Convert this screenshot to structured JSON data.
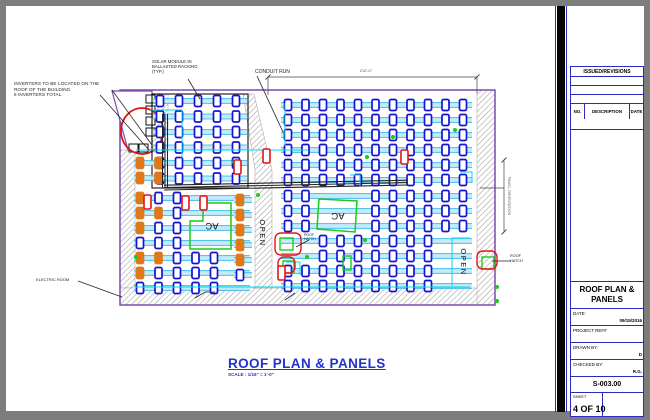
{
  "notes": {
    "inverters": "INVERTERS TO BE LOCATED ON THE\nROOF OF THE BUILDING.\n6 INVERTERS TOTAL.",
    "solar_module": "SOLAR MODULE IN\nBALLASTED RACKING\n(TYP.)",
    "conduit_run": "CONDUIT RUN",
    "electric_room": "ELECTRIC ROOM",
    "roof_hatch_right": "ROOF\nHATCH",
    "roof_hatch_center": "ROOF\nHATCH",
    "ac1": "AC",
    "ac2": "AC",
    "open1": "OPEN",
    "open2": "OPEN",
    "top_dimension": "210'-0\"",
    "right_dimension": "PANEL ORIENTATION"
  },
  "drawing_title": {
    "title": "ROOF PLAN & PANELS",
    "scale": "SCALE : 1/16\" = 1'-0\""
  },
  "title_block": {
    "issued_revisions": "ISSUED/REVISIONS",
    "col_no": "NO.",
    "col_description": "DESCRIPTION",
    "col_date": "DATE",
    "title_line1": "ROOF PLAN &",
    "title_line2": "PANELS",
    "date_label": "DATE:",
    "date_value": "09/15/2016",
    "project_ref_label": "PROJECT REF#",
    "project_ref_value": "",
    "drawn_by_label": "DRAWN BY:",
    "drawn_by_value": "D",
    "checked_by_label": "CHECKED BY:",
    "checked_by_value": "R.G.",
    "sheet_number": "S-003.00",
    "sheet_label": "SHEET",
    "sheet_value": "4 OF 10"
  },
  "plan": {
    "colors": {
      "hatch": "#9f9f9f",
      "outline": "#7c4bad",
      "rail": "#5bc4ee",
      "railmid": "#c4ebfa",
      "module": "#1515d0",
      "orange": "#e07818",
      "red": "#e51313",
      "green": "#19cc19",
      "cyan": "#00d8e8",
      "black": "#1a1a1a",
      "dim": "#444444"
    },
    "roof": {
      "x": 120,
      "y": 90,
      "w": 375,
      "h": 215
    },
    "hatch_rects": [
      [
        120,
        150,
        15,
        138
      ],
      [
        120,
        288,
        375,
        17
      ],
      [
        477,
        90,
        18,
        215
      ],
      [
        152,
        94,
        16,
        58
      ]
    ],
    "hatch_polys": [
      "243,94 254,94 272,170 272,288 255,288 255,170"
    ],
    "trapezoid": "112,91 152,91 152,150 128,150",
    "inverter_boxes": [
      [
        146,
        95
      ],
      [
        146,
        106
      ],
      [
        146,
        117
      ],
      [
        146,
        128
      ],
      [
        129,
        144
      ],
      [
        139,
        144
      ]
    ],
    "red_ellipse": {
      "cx": 142,
      "cy": 131,
      "rx": 21,
      "ry": 23
    },
    "array_frame": [
      152,
      94,
      96,
      94
    ],
    "arrays": [
      {
        "x0": 160,
        "y0": 101,
        "cols": 5,
        "dx": 19,
        "rows": 6,
        "dy": 15.5,
        "railX1": 153,
        "railX2": 247,
        "skip": [],
        "orange": []
      },
      {
        "x0": 288,
        "y0": 105,
        "cols": 11,
        "dx": 17.5,
        "rows": 6,
        "dy": 15,
        "railX1": 281,
        "railX2": 472,
        "skip": [],
        "orange": []
      },
      {
        "x0": 288,
        "y0": 196,
        "cols": 11,
        "dx": 17.5,
        "rows": 7,
        "dy": 15,
        "railX1": 281,
        "railX2": 472,
        "skip": [
          [
            2,
            0
          ],
          [
            3,
            0
          ],
          [
            4,
            0
          ],
          [
            2,
            1
          ],
          [
            3,
            1
          ],
          [
            4,
            1
          ],
          [
            2,
            2
          ],
          [
            3,
            2
          ],
          [
            4,
            2
          ],
          [
            0,
            3
          ],
          [
            1,
            3
          ],
          [
            0,
            4
          ],
          [
            1,
            4
          ],
          [
            9,
            3
          ],
          [
            10,
            3
          ],
          [
            9,
            4
          ],
          [
            10,
            4
          ],
          [
            9,
            5
          ],
          [
            10,
            5
          ],
          [
            9,
            6
          ],
          [
            10,
            6
          ]
        ],
        "orange": []
      },
      {
        "x0": 140,
        "y0": 198,
        "cols": 5,
        "dx": 18.5,
        "rows": 7,
        "dy": 15,
        "railX1": 134,
        "railX2": 250,
        "skip": [
          [
            3,
            0
          ],
          [
            4,
            0
          ],
          [
            3,
            1
          ],
          [
            4,
            1
          ],
          [
            3,
            2
          ],
          [
            4,
            2
          ],
          [
            3,
            3
          ],
          [
            4,
            3
          ]
        ],
        "orange": [
          [
            0,
            0
          ],
          [
            0,
            1
          ],
          [
            0,
            2
          ],
          [
            1,
            1
          ],
          [
            0,
            4
          ],
          [
            1,
            4
          ],
          [
            0,
            5
          ]
        ]
      },
      {
        "x0": 240,
        "y0": 200,
        "cols": 1,
        "dx": 18,
        "rows": 6,
        "dy": 15,
        "railX1": 234,
        "railX2": 252,
        "skip": [],
        "orange": [
          [
            0,
            0
          ],
          [
            0,
            1
          ],
          [
            0,
            2
          ],
          [
            0,
            3
          ],
          [
            0,
            4
          ]
        ]
      },
      {
        "x0": 140,
        "y0": 163,
        "cols": 2,
        "dx": 18.5,
        "rows": 2,
        "dy": 15,
        "railX1": 134,
        "railX2": 168,
        "skip": [],
        "orange": [
          [
            0,
            0
          ],
          [
            1,
            0
          ],
          [
            0,
            1
          ],
          [
            1,
            1
          ]
        ]
      }
    ],
    "module": {
      "w": 7,
      "h": 11,
      "rx": 1.5
    },
    "conduit": {
      "x1": 164,
      "x2": 408,
      "y1": 190,
      "y2": 185,
      "lines": 3,
      "gap": 2.4,
      "verticals": [
        162.5,
        165,
        167.5
      ],
      "vy1": 114,
      "vy2": 188
    },
    "ac_shapes": [
      "190,221 203,221 203,203 231,203 231,249 190,249",
      "319,199 357,201 355,232 317,229"
    ],
    "green_squares": [
      [
        280,
        238,
        13,
        12
      ],
      [
        283,
        261,
        11,
        12
      ],
      [
        482,
        257,
        12,
        12
      ],
      [
        343,
        256,
        8,
        14
      ]
    ],
    "green_dots": [
      [
        234,
        162
      ],
      [
        367,
        157
      ],
      [
        393,
        137
      ],
      [
        365,
        240
      ],
      [
        307,
        257
      ],
      [
        497,
        287
      ],
      [
        497,
        301
      ],
      [
        136,
        257
      ],
      [
        258,
        195
      ],
      [
        455,
        130
      ]
    ],
    "red_rounds": [
      [
        275,
        233,
        26,
        22
      ],
      [
        278,
        257,
        17,
        16
      ],
      [
        477,
        251,
        20,
        18
      ]
    ],
    "red_modules": [
      [
        234,
        160
      ],
      [
        263,
        149
      ],
      [
        182,
        196
      ],
      [
        200,
        196
      ],
      [
        401,
        150
      ],
      [
        278,
        266
      ],
      [
        144,
        195
      ]
    ],
    "cyan_lines": [
      [
        150,
        110,
        182,
        110,
        182,
        158
      ],
      [
        136,
        150,
        308,
        150
      ],
      [
        285,
        103,
        285,
        146
      ],
      [
        460,
        172,
        472,
        172,
        472,
        183
      ],
      [
        350,
        175,
        360,
        175,
        360,
        186
      ],
      [
        286,
        262,
        300,
        262,
        300,
        275
      ],
      [
        136,
        287,
        470,
        287
      ],
      [
        452,
        238,
        452,
        286
      ],
      [
        452,
        238,
        470,
        238
      ]
    ],
    "leaders": [
      [
        100,
        95,
        149,
        150
      ],
      [
        112,
        90,
        152,
        145
      ],
      [
        188,
        79,
        200,
        99
      ],
      [
        257,
        76,
        283,
        132
      ],
      [
        78,
        281,
        122,
        297
      ],
      [
        511,
        261,
        492,
        261
      ],
      [
        309,
        240,
        296,
        247
      ],
      [
        195,
        298,
        205,
        292,
        215,
        292
      ],
      [
        285,
        300,
        295,
        293
      ]
    ],
    "dims": {
      "top": {
        "x1": 268,
        "x2": 477,
        "y": 77,
        "ext1": 95,
        "ext2": 93
      },
      "right": {
        "x": 504,
        "y1": 160,
        "y2": 232,
        "tickx1": 480,
        "ticky": 188
      }
    }
  }
}
